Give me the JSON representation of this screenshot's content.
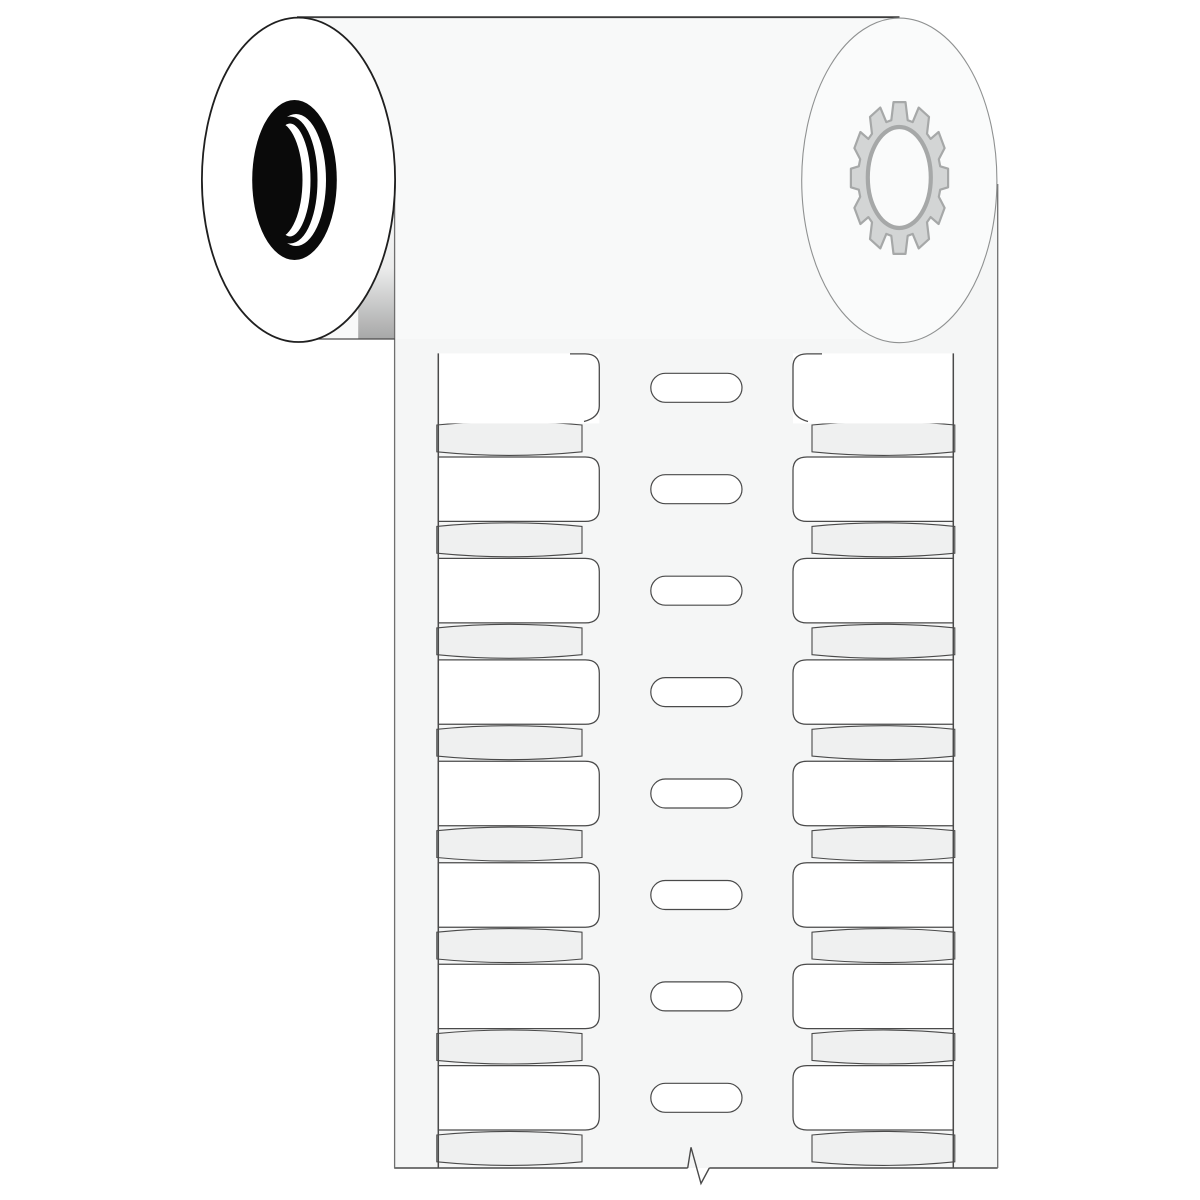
{
  "illustration": {
    "subject": "Roll of blank wire-marker sleeve labels on a liner strip",
    "roll": {
      "left_flange_core": "core-hole-icon",
      "right_flange_core": "gear-icon"
    },
    "strip": {
      "columns": 2,
      "full_labels_per_column": 7,
      "partial_labels_per_column": 1,
      "carrier_bands_per_column": 8,
      "feed_slots": 8,
      "break_mark": "break-mark-icon"
    }
  },
  "icons": {
    "gear": "gear-icon",
    "core": "core-hole-icon",
    "break": "break-mark-icon"
  },
  "colors": {
    "page": "#ffffff",
    "roll_body": "#f8f9f9",
    "roll_top_edge": "#3c3c3c",
    "roll_bottom_edge": "#4a4a4a",
    "left_flange_fill": "#ffffff",
    "left_flange_stroke": "#1f1f1f",
    "core_black": "#0a0a0a",
    "core_white": "#ffffff",
    "right_flange_fill": "#fafbfb",
    "right_flange_stroke": "#8f9191",
    "gear_fill": "#d3d5d5",
    "gear_stroke": "#a6a8a8",
    "strip_fill": "#f5f6f6",
    "strip_edge": "#6f6f6f",
    "outline": "#4a4a4a",
    "label_fill": "#ffffff",
    "band_fill": "#eff0f0",
    "shadow": "#565656"
  }
}
